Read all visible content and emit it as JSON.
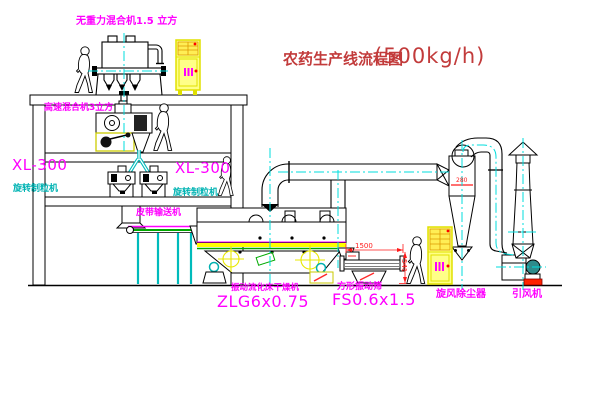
{
  "title": {
    "text": "农药生产线流程图",
    "capacity": "(500kg/h)"
  },
  "equipment": {
    "gravity_mixer": {
      "label": "无重力混合机1.5 立方"
    },
    "high_speed_mixer": {
      "label": "高速混合机3立方"
    },
    "granulator_left": {
      "model": "XL-300",
      "name": "旋转制粒机"
    },
    "granulator_center": {
      "model": "XL-300",
      "name": "旋转制粒机"
    },
    "belt_conveyor": {
      "label": "皮带输送机"
    },
    "fluid_bed_dryer": {
      "name": "振动流化床干燥机",
      "model": "ZLG6x0.75"
    },
    "vibrating_sieve": {
      "name": "方形振动筛",
      "model": "FS0.6x1.5",
      "dim_width": "1500",
      "dim_height": "541"
    },
    "cyclone": {
      "name": "旋风除尘器",
      "dim_label": "280"
    },
    "fan": {
      "name": "引风机"
    }
  },
  "colors": {
    "label_magenta": "#ff00ff",
    "label_cyan": "#00b3b3",
    "title_red": "#c23b3b",
    "dimension_red": "#ff1a1a",
    "centerline_cyan": "#00dddd",
    "cabinet_yellow": "#ffff88",
    "deck_yellow": "#ffff00",
    "deck_green": "#00aa00"
  }
}
